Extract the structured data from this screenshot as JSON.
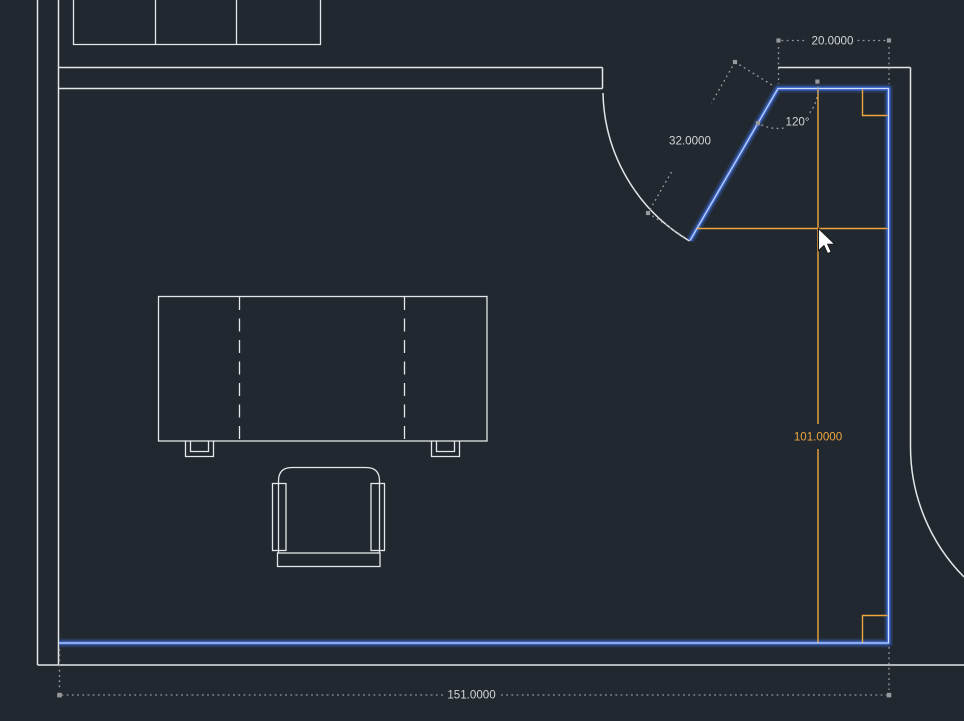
{
  "canvas": {
    "width": 964,
    "height": 721,
    "background": "#212830"
  },
  "colors": {
    "background": "#212830",
    "wall_line": "#e4e6e8",
    "selection_highlight_blue": "#4b79dd",
    "dynamic_dimension_orange": "#eca63f",
    "dimension_line_gray": "#97999c",
    "dimension_text_gray": "#d3d5d7"
  },
  "dimensions": {
    "top_width": {
      "value": "20.0000"
    },
    "door_wall_length": {
      "value": "32.0000"
    },
    "door_angle": {
      "value": "120°"
    },
    "right_wall_height": {
      "value": "101.0000"
    },
    "bottom_width": {
      "value": "151.0000"
    }
  },
  "cursor": {
    "shape": "arrow",
    "tip_x": 818,
    "tip_y": 228
  }
}
